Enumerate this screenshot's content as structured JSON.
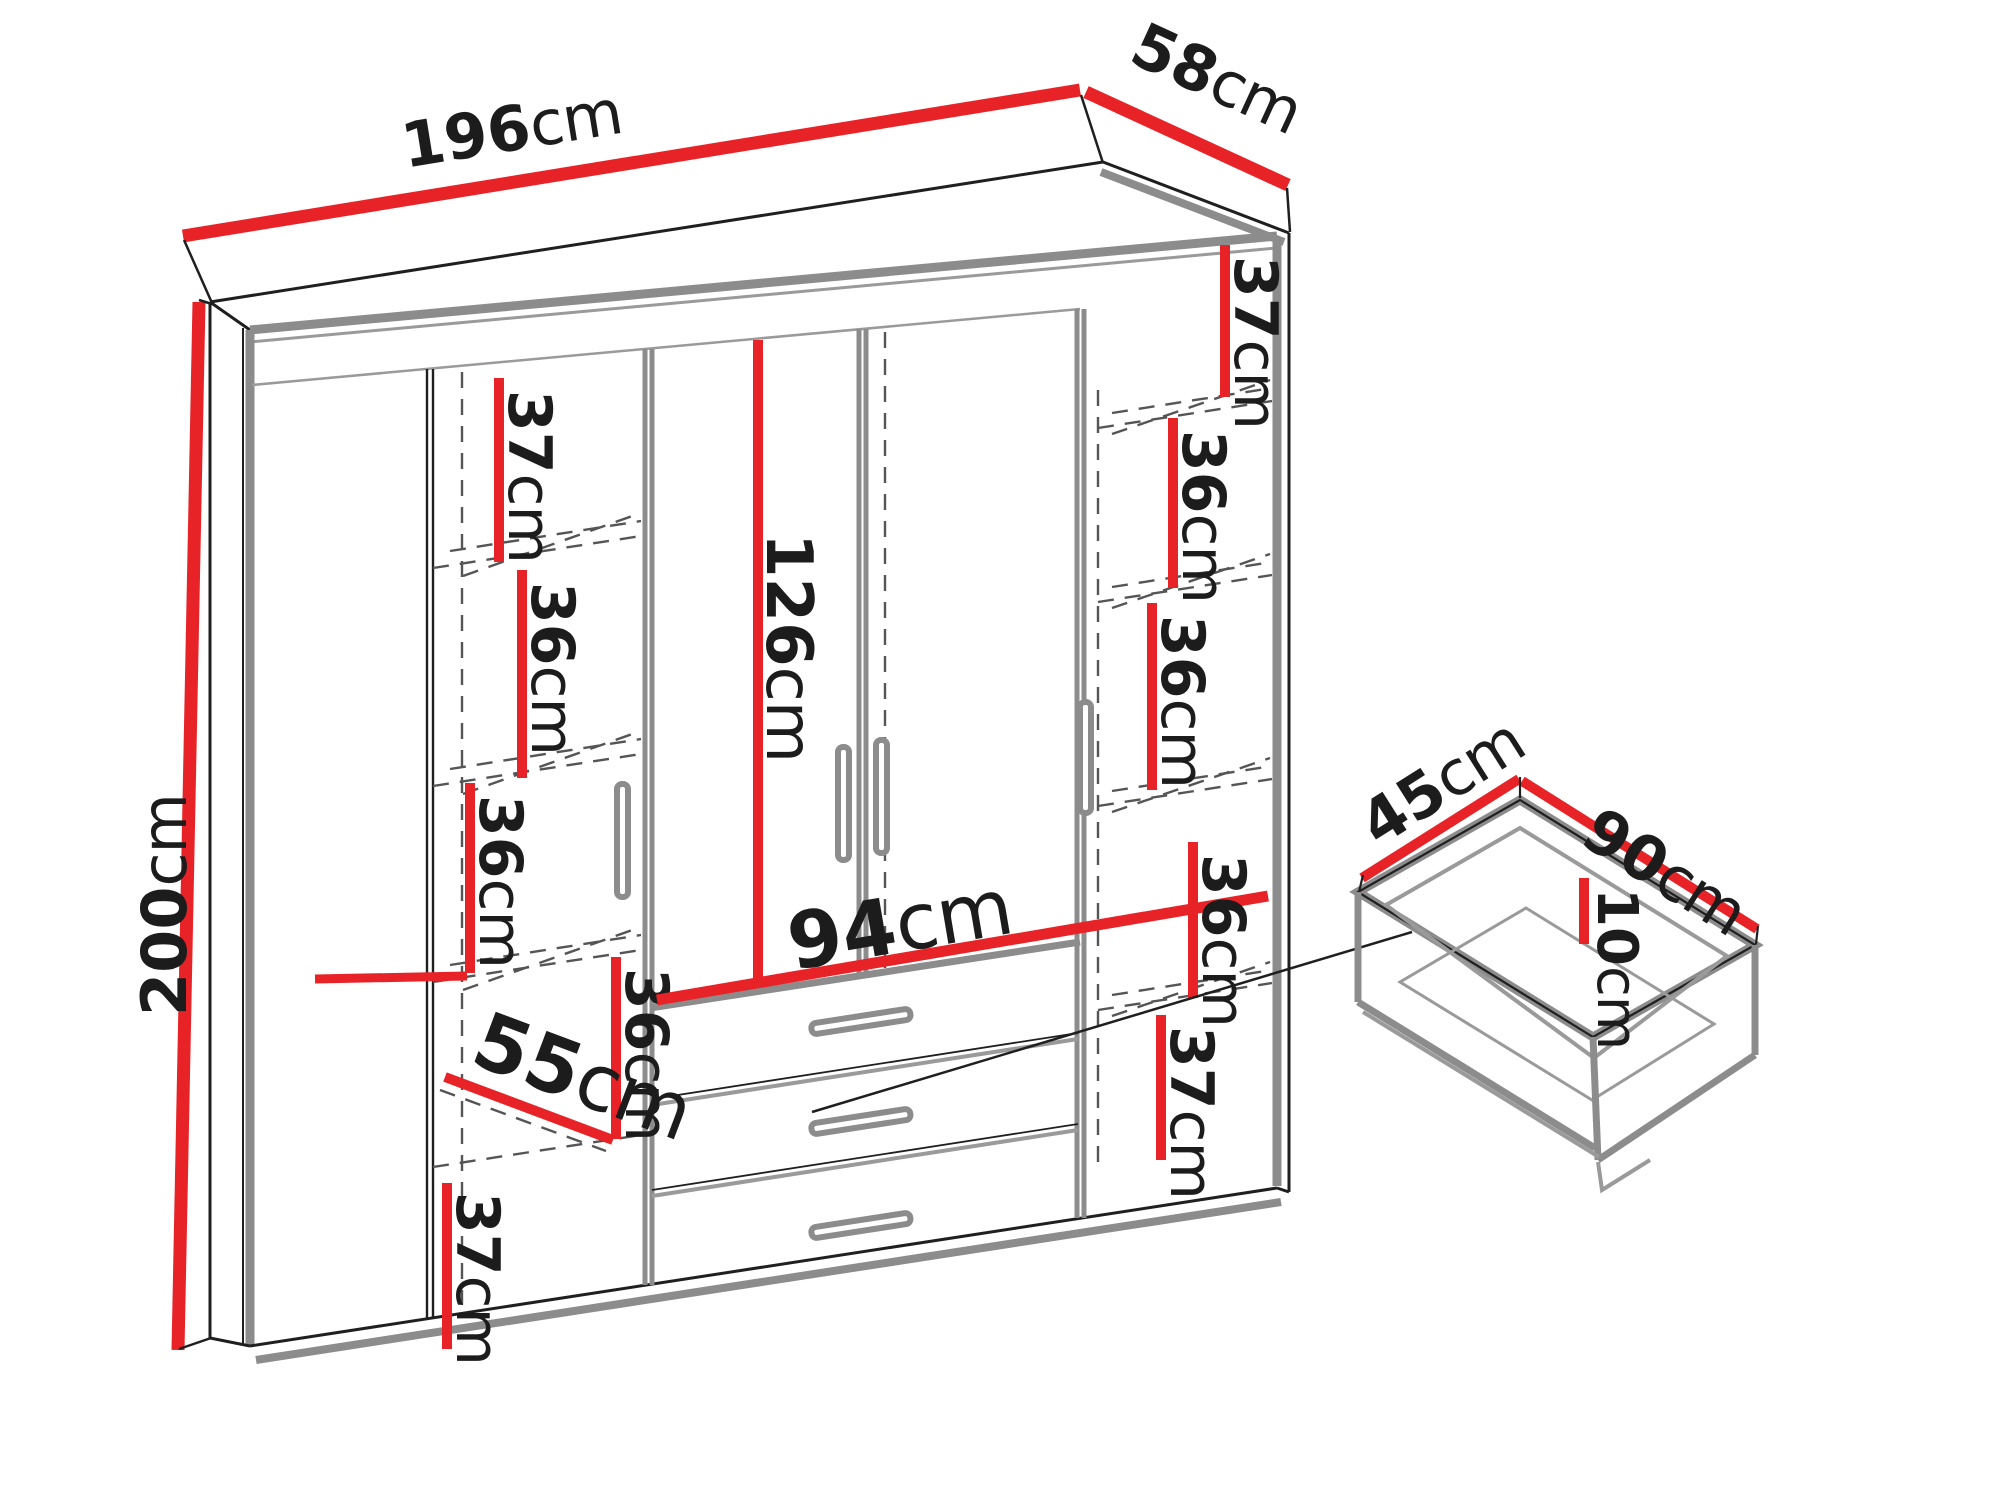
{
  "diagram": {
    "type": "furniture-dimension-diagram",
    "unit": "cm",
    "colors": {
      "dimension_line": "#e82328",
      "edge_gray": "#8c8c8c",
      "outline": "#1f1f1f"
    },
    "wardrobe": {
      "overall": {
        "width": {
          "num": "196",
          "unit": "cm"
        },
        "depth": {
          "num": "58",
          "unit": "cm"
        },
        "height": {
          "num": "200",
          "unit": "cm"
        }
      },
      "interior": {
        "hanging_section_height": {
          "num": "126",
          "unit": "cm"
        },
        "drawer_section_width": {
          "num": "94",
          "unit": "cm"
        },
        "wide_compartment_width": {
          "num": "55",
          "unit": "cm"
        },
        "left_column_shelves": [
          {
            "num": "37",
            "unit": "cm"
          },
          {
            "num": "36",
            "unit": "cm"
          },
          {
            "num": "36",
            "unit": "cm"
          },
          {
            "num": "36",
            "unit": "cm"
          },
          {
            "num": "37",
            "unit": "cm"
          }
        ],
        "right_column_shelves": [
          {
            "num": "37",
            "unit": "cm"
          },
          {
            "num": "36",
            "unit": "cm"
          },
          {
            "num": "36",
            "unit": "cm"
          },
          {
            "num": "36",
            "unit": "cm"
          },
          {
            "num": "37",
            "unit": "cm"
          }
        ]
      }
    },
    "drawer_detail": {
      "depth": {
        "num": "45",
        "unit": "cm"
      },
      "width": {
        "num": "90",
        "unit": "cm"
      },
      "height": {
        "num": "10",
        "unit": "cm"
      }
    }
  }
}
